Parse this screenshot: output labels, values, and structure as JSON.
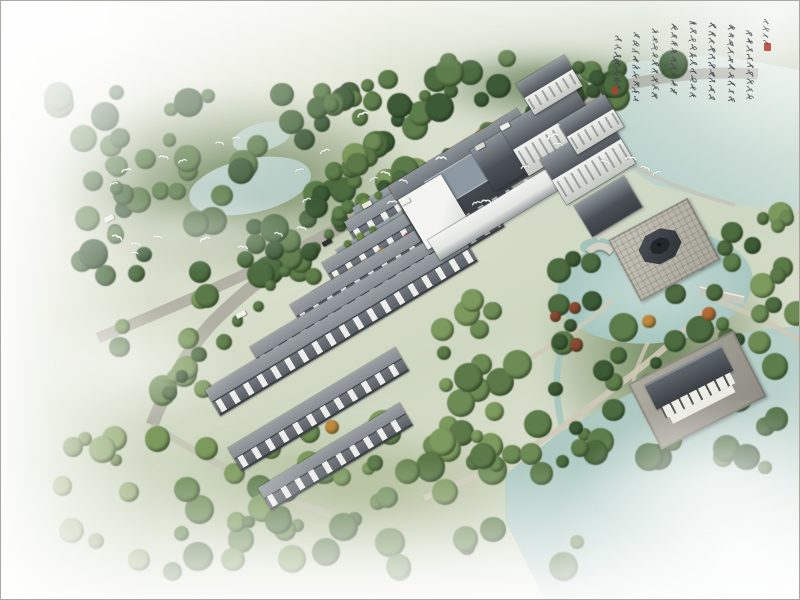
{
  "scene": {
    "type": "aerial architectural rendering of a Chinese-style riverside residential complex",
    "birds": [
      [
        356,
        104,
        1
      ],
      [
        318,
        141,
        0.9
      ],
      [
        293,
        160,
        0.8
      ],
      [
        435,
        148,
        1
      ],
      [
        380,
        163,
        0.9
      ],
      [
        367,
        169,
        0.8
      ],
      [
        398,
        171,
        0.8
      ],
      [
        386,
        192,
        0.9
      ],
      [
        300,
        190,
        0.8
      ],
      [
        296,
        218,
        0.9
      ],
      [
        273,
        224,
        0.8
      ],
      [
        519,
        157,
        0.8
      ],
      [
        546,
        126,
        1.1
      ],
      [
        552,
        134,
        0.9
      ],
      [
        600,
        152,
        0.9
      ],
      [
        625,
        148,
        1
      ],
      [
        640,
        158,
        0.9
      ],
      [
        650,
        163,
        0.8
      ],
      [
        522,
        171,
        0.7
      ],
      [
        480,
        191,
        0.9
      ],
      [
        470,
        193,
        0.8
      ],
      [
        120,
        160,
        0.9
      ],
      [
        107,
        174,
        0.8
      ],
      [
        158,
        147,
        0.9
      ],
      [
        176,
        151,
        0.8
      ],
      [
        112,
        227,
        1
      ],
      [
        130,
        234,
        0.9
      ],
      [
        152,
        227,
        0.8
      ],
      [
        198,
        229,
        1
      ],
      [
        237,
        237,
        0.9
      ],
      [
        128,
        243,
        0.8
      ],
      [
        214,
        133,
        0.8
      ],
      [
        230,
        128,
        0.7
      ]
    ],
    "cars": [
      [
        500,
        124,
        "#eeeeea"
      ],
      [
        475,
        144,
        "#d8d8d0"
      ],
      [
        400,
        199,
        "#f1f1ed"
      ],
      [
        362,
        202,
        "#e8e8e2"
      ],
      [
        322,
        240,
        "#2b2e31"
      ],
      [
        236,
        312,
        "#f2f2ee"
      ],
      [
        104,
        216,
        "#ececE6"
      ]
    ]
  },
  "calligraphy": {
    "title": "庚子夏日",
    "columns": [
      "雲樹繞堤沙怒濤卷霜",
      "雪天塹無涯市列珠璣戶",
      "盈羅綺競豪奢重湖疊巘",
      "清嘉有三秋桂子十里荷",
      "花羌管弄晴菱歌泛夜",
      "嬉嬉釣叟蓮娃千騎擁",
      "高牙乘醉聽簫鼓吟賞",
      "煙霞異日圖將好"
    ],
    "signature": "柳永望海潮",
    "ink_color": "#45494c",
    "seal_color": "#b8402c"
  },
  "colors": {
    "water": "#a9c9c3",
    "lake_fade": "#e4ebe5",
    "roof_dark": "#474d53",
    "roof_light": "#9aa0a4",
    "wall_white": "#f2f3f0",
    "road": "#aaa89e",
    "path": "#cfc9b8",
    "tree_dark": "#42603a",
    "tree_mid": "#5c7a49",
    "tree_light": "#7d9a5e",
    "autumn_orange": "#c08a3e",
    "autumn_red": "#8a4a33",
    "stone": "#b5b2a6",
    "pavilion_roof": "#34393e",
    "grass": "#cdd6c2",
    "fog": "#ffffff"
  }
}
